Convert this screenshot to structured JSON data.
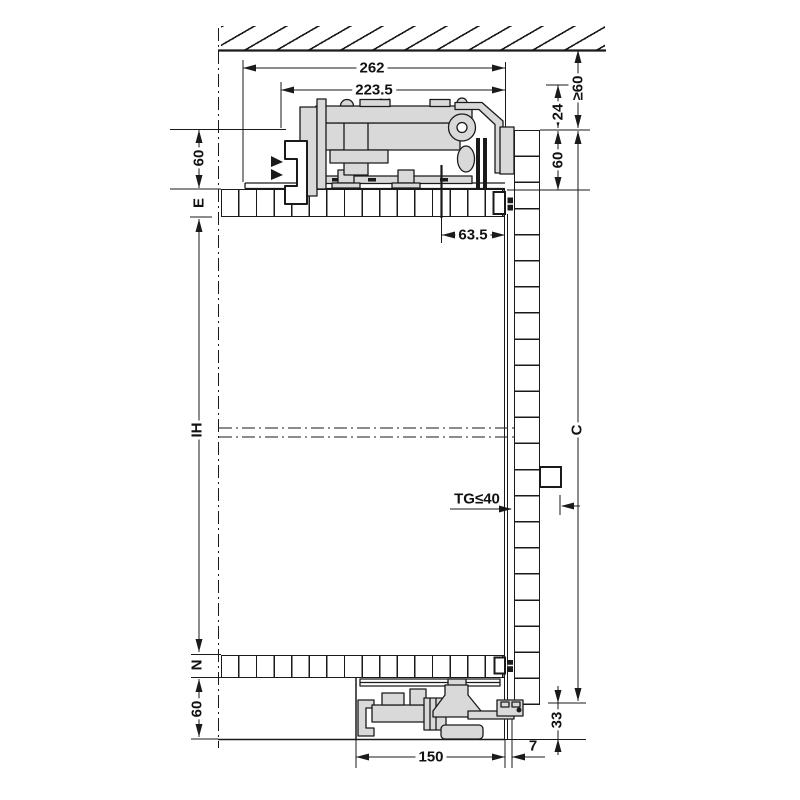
{
  "dims": {
    "top_width": "262",
    "track_width": "223.5",
    "front_offset": "63.5",
    "ceiling_clearance": "≥60",
    "track_drop": "24",
    "top_zone_right": "60",
    "top_zone_left": "60",
    "top_panel_thickness": "E",
    "interior_height": "IH",
    "door_height": "C",
    "door_thickness": "TG≤40",
    "bottom_panel_thickness": "N",
    "bottom_zone": "60",
    "guide_length": "150",
    "bottom_gap": "33",
    "front_reveal": "7"
  },
  "colors": {
    "part_fill": "#d9d9d9",
    "line": "#1a1a1a",
    "background": "#ffffff"
  }
}
